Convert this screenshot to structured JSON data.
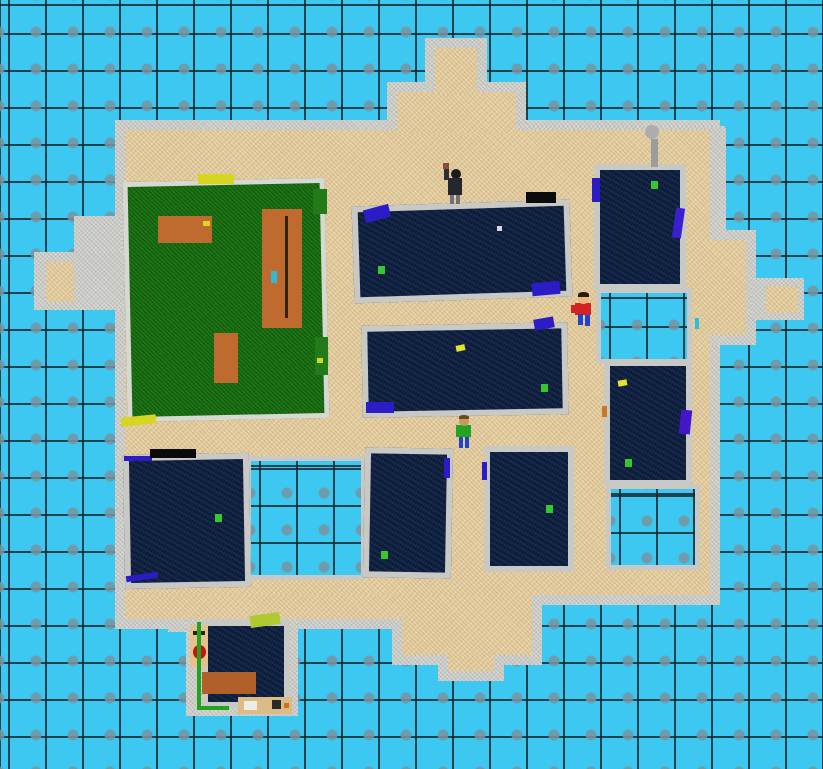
{
  "scene": {
    "width": 823,
    "height": 769
  },
  "palette": {
    "water": "#3DC8F2",
    "grid_line": "#222C30",
    "tile_square": "#8FA4B0",
    "sand": "#E2CB9C",
    "concrete": "#C8C8C4",
    "wall_light": "#D8D8D2",
    "grass": "#156B0F",
    "roof_navy": "#10203E",
    "table_orange": "#BF6B30",
    "marker_green": "#35C82E",
    "marker_yellow": "#E3E32A",
    "flag_blue": "#2B1CC6",
    "shirt_red": "#D22222",
    "shirt_green": "#22A322",
    "pants_blue": "#2244C8"
  },
  "island": {
    "rim": 10,
    "sand": [
      {
        "name": "island-core",
        "x": 125,
        "y": 130,
        "w": 585,
        "h": 465
      },
      {
        "name": "island-east-bulge",
        "x": 700,
        "y": 240,
        "w": 46,
        "h": 95
      },
      {
        "name": "island-southwest-strip",
        "x": 125,
        "y": 595,
        "w": 280,
        "h": 24
      },
      {
        "name": "south-pier-wide",
        "x": 402,
        "y": 595,
        "w": 130,
        "h": 60
      },
      {
        "name": "south-pier-nub",
        "x": 448,
        "y": 655,
        "w": 46,
        "h": 16
      },
      {
        "name": "north-pier-wide",
        "x": 397,
        "y": 92,
        "w": 119,
        "h": 42
      },
      {
        "name": "north-pier-nub",
        "x": 435,
        "y": 48,
        "w": 42,
        "h": 46
      }
    ],
    "concrete": [
      {
        "name": "west-arm-platform",
        "x": 34,
        "y": 252,
        "w": 92,
        "h": 58
      },
      {
        "name": "east-platform",
        "x": 752,
        "y": 278,
        "w": 52,
        "h": 42
      },
      {
        "name": "north-wall-band",
        "x": 525,
        "y": 126,
        "w": 200,
        "h": 16
      },
      {
        "name": "northeast-rim-wall",
        "x": 706,
        "y": 128,
        "w": 20,
        "h": 112
      },
      {
        "name": "northwest-step",
        "x": 74,
        "y": 216,
        "w": 48,
        "h": 36
      },
      {
        "name": "southwest-step",
        "x": 168,
        "y": 604,
        "w": 36,
        "h": 28
      },
      {
        "name": "shop-pad",
        "x": 186,
        "y": 616,
        "w": 112,
        "h": 100
      }
    ],
    "sand_pads": [
      {
        "name": "west-arm-sand-pad",
        "x": 46,
        "y": 262,
        "w": 28,
        "h": 40
      },
      {
        "name": "east-platform-sand-pad",
        "x": 766,
        "y": 286,
        "w": 32,
        "h": 27
      }
    ]
  },
  "pools": [
    {
      "name": "pool-southwest",
      "x": 246,
      "y": 456,
      "w": 120,
      "h": 124
    },
    {
      "name": "pool-east-upper",
      "x": 596,
      "y": 288,
      "w": 96,
      "h": 76
    },
    {
      "name": "pool-east-lower",
      "x": 606,
      "y": 484,
      "w": 94,
      "h": 86
    }
  ],
  "park": {
    "base": {
      "name": "park-lawn",
      "x": 125,
      "y": 180,
      "w": 202,
      "h": 240,
      "rot": -1.2
    },
    "items": [
      {
        "name": "picnic-table-small",
        "x": 158,
        "y": 216,
        "w": 54,
        "h": 27,
        "color": "#BF6B30"
      },
      {
        "name": "picnic-table-small-dot",
        "x": 203,
        "y": 221,
        "w": 7,
        "h": 5,
        "color": "#D8D820"
      },
      {
        "name": "picnic-table-large",
        "x": 262,
        "y": 209,
        "w": 40,
        "h": 119,
        "color": "#BF6B30"
      },
      {
        "name": "picnic-bench-line",
        "x": 285,
        "y": 216,
        "w": 3,
        "h": 102,
        "color": "#33230E"
      },
      {
        "name": "table-item-cyan",
        "x": 271,
        "y": 271,
        "w": 6,
        "h": 12,
        "color": "#2EB9DC"
      },
      {
        "name": "tree-stump",
        "x": 214,
        "y": 333,
        "w": 24,
        "h": 50,
        "color": "#BF6B30"
      },
      {
        "name": "bench-yellow-north",
        "x": 198,
        "y": 174,
        "w": 36,
        "h": 10,
        "color": "#D6D622"
      },
      {
        "name": "bench-yellow-south",
        "x": 121,
        "y": 416,
        "w": 35,
        "h": 9,
        "color": "#D6D622",
        "rot": -6
      },
      {
        "name": "bench-green-east-a",
        "x": 313,
        "y": 189,
        "w": 14,
        "h": 25,
        "color": "#237A18"
      },
      {
        "name": "bench-green-east-b",
        "x": 315,
        "y": 337,
        "w": 13,
        "h": 38,
        "color": "#237A18"
      },
      {
        "name": "bench-green-east-dot",
        "x": 317,
        "y": 358,
        "w": 6,
        "h": 5,
        "color": "#D6D622"
      }
    ]
  },
  "buildings": [
    {
      "name": "building-north-long",
      "x": 353,
      "y": 203,
      "w": 218,
      "h": 97,
      "rot": -1.8
    },
    {
      "name": "building-mid-long",
      "x": 362,
      "y": 324,
      "w": 206,
      "h": 92,
      "rot": -1
    },
    {
      "name": "building-northeast",
      "x": 594,
      "y": 164,
      "w": 92,
      "h": 126,
      "rot": 0
    },
    {
      "name": "building-east",
      "x": 604,
      "y": 360,
      "w": 88,
      "h": 126,
      "rot": 0
    },
    {
      "name": "building-southwest",
      "x": 124,
      "y": 454,
      "w": 126,
      "h": 134,
      "rot": -1
    },
    {
      "name": "building-south-a",
      "x": 364,
      "y": 448,
      "w": 88,
      "h": 130,
      "rot": 1
    },
    {
      "name": "building-south-b",
      "x": 484,
      "y": 446,
      "w": 90,
      "h": 126,
      "rot": 0
    },
    {
      "name": "shop-roof",
      "x": 202,
      "y": 620,
      "w": 88,
      "h": 88,
      "rot": 0
    }
  ],
  "marks": [
    {
      "name": "roof-marker-green",
      "x": 378,
      "y": 266,
      "w": 7,
      "h": 8,
      "color": "#35C82E"
    },
    {
      "name": "roof-marker-green",
      "x": 541,
      "y": 384,
      "w": 7,
      "h": 8,
      "color": "#35C82E"
    },
    {
      "name": "roof-marker-green",
      "x": 651,
      "y": 181,
      "w": 7,
      "h": 8,
      "color": "#35C82E"
    },
    {
      "name": "roof-marker-green",
      "x": 625,
      "y": 459,
      "w": 7,
      "h": 8,
      "color": "#35C82E"
    },
    {
      "name": "roof-marker-green",
      "x": 215,
      "y": 514,
      "w": 7,
      "h": 8,
      "color": "#35C82E"
    },
    {
      "name": "roof-marker-green",
      "x": 381,
      "y": 551,
      "w": 7,
      "h": 8,
      "color": "#35C82E"
    },
    {
      "name": "roof-marker-green",
      "x": 546,
      "y": 505,
      "w": 7,
      "h": 8,
      "color": "#35C82E"
    },
    {
      "name": "roof-marker-yellow",
      "x": 456,
      "y": 345,
      "w": 9,
      "h": 6,
      "color": "#E3E32A",
      "rot": -12
    },
    {
      "name": "roof-marker-yellow",
      "x": 618,
      "y": 380,
      "w": 9,
      "h": 6,
      "color": "#E3E32A",
      "rot": -10
    },
    {
      "name": "roof-speck-white",
      "x": 497,
      "y": 226,
      "w": 5,
      "h": 5,
      "color": "#D8D8D8"
    },
    {
      "name": "roof-flag-blue",
      "x": 364,
      "y": 207,
      "w": 26,
      "h": 13,
      "color": "#2B1CC6",
      "rot": -15
    },
    {
      "name": "roof-flag-blue",
      "x": 532,
      "y": 282,
      "w": 28,
      "h": 13,
      "color": "#2B1CC6",
      "rot": -5
    },
    {
      "name": "roof-flag-blue",
      "x": 592,
      "y": 178,
      "w": 8,
      "h": 24,
      "color": "#2B1CC6"
    },
    {
      "name": "roof-flag-blue",
      "x": 674,
      "y": 208,
      "w": 9,
      "h": 30,
      "color": "#3A1FD0",
      "rot": 8
    },
    {
      "name": "roof-flag-blue",
      "x": 534,
      "y": 318,
      "w": 20,
      "h": 11,
      "color": "#2B1CC6",
      "rot": -10
    },
    {
      "name": "roof-flag-blue",
      "x": 366,
      "y": 402,
      "w": 28,
      "h": 11,
      "color": "#2B1CC6"
    },
    {
      "name": "roof-flag-blue",
      "x": 680,
      "y": 410,
      "w": 11,
      "h": 24,
      "color": "#4416C8",
      "rot": 6
    },
    {
      "name": "roof-flag-blue",
      "x": 444,
      "y": 458,
      "w": 6,
      "h": 20,
      "color": "#2B1CC6"
    },
    {
      "name": "roof-flag-blue",
      "x": 482,
      "y": 462,
      "w": 5,
      "h": 18,
      "color": "#2B1CC6"
    },
    {
      "name": "roof-flag-blue",
      "x": 124,
      "y": 456,
      "w": 28,
      "h": 5,
      "color": "#2B1CC6"
    },
    {
      "name": "roof-flag-blue",
      "x": 126,
      "y": 574,
      "w": 32,
      "h": 6,
      "color": "#2B1CC6",
      "rot": -8
    },
    {
      "name": "roof-speck-orange",
      "x": 602,
      "y": 406,
      "w": 5,
      "h": 11,
      "color": "#C87828"
    },
    {
      "name": "bench-black",
      "x": 526,
      "y": 192,
      "w": 30,
      "h": 11,
      "color": "#0B0B0B"
    },
    {
      "name": "bench-black",
      "x": 150,
      "y": 449,
      "w": 46,
      "h": 9,
      "color": "#0B0B0B"
    },
    {
      "name": "lamppost-head",
      "x": 645,
      "y": 125,
      "w": 14,
      "h": 14,
      "color": "#ADADAD",
      "round": true
    },
    {
      "name": "lamppost-stem",
      "x": 651,
      "y": 139,
      "w": 7,
      "h": 28,
      "color": "#9C9C9C"
    },
    {
      "name": "speck-teal",
      "x": 695,
      "y": 318,
      "w": 4,
      "h": 11,
      "color": "#28C0DC"
    }
  ],
  "shop_items": [
    {
      "name": "shop-face-board",
      "x": 190,
      "y": 625,
      "w": 18,
      "h": 42,
      "color": "#E5C18E"
    },
    {
      "name": "shop-face-eye-left",
      "x": 193,
      "y": 631,
      "w": 4,
      "h": 4,
      "color": "#222222"
    },
    {
      "name": "shop-face-eye-right",
      "x": 201,
      "y": 631,
      "w": 4,
      "h": 4,
      "color": "#222222"
    },
    {
      "name": "shop-face-mouth",
      "x": 193,
      "y": 645,
      "w": 13,
      "h": 14,
      "color": "#C61414",
      "round": true
    },
    {
      "name": "shop-counter-brown",
      "x": 202,
      "y": 672,
      "w": 54,
      "h": 22,
      "color": "#B06028"
    },
    {
      "name": "shop-roof-blob",
      "x": 250,
      "y": 614,
      "w": 30,
      "h": 12,
      "color": "#AFC930",
      "rot": -8
    },
    {
      "name": "shop-workbench",
      "x": 238,
      "y": 697,
      "w": 54,
      "h": 17,
      "color": "#DCBC86"
    },
    {
      "name": "shop-workbench-sink",
      "x": 244,
      "y": 701,
      "w": 13,
      "h": 9,
      "color": "#EDEDE8"
    },
    {
      "name": "shop-workbench-stove",
      "x": 272,
      "y": 700,
      "w": 9,
      "h": 9,
      "color": "#2A2A2A"
    },
    {
      "name": "shop-workbench-dot",
      "x": 284,
      "y": 703,
      "w": 5,
      "h": 5,
      "color": "#D07020"
    },
    {
      "name": "shop-edge-green-left",
      "x": 197,
      "y": 622,
      "w": 4,
      "h": 88,
      "color": "#22A31E"
    },
    {
      "name": "shop-edge-green-bottom",
      "x": 197,
      "y": 706,
      "w": 32,
      "h": 4,
      "color": "#22A31E"
    }
  ],
  "characters": [
    {
      "name": "character-dark-figure",
      "parts": [
        {
          "part": "raised-arm",
          "x": 444,
          "y": 167,
          "w": 5,
          "h": 13,
          "color": "#2E2E38"
        },
        {
          "part": "held-item",
          "x": 443,
          "y": 163,
          "w": 6,
          "h": 6,
          "color": "#8E4A3A"
        },
        {
          "part": "head",
          "x": 451,
          "y": 169,
          "w": 10,
          "h": 10,
          "color": "#1C1C1C",
          "round": true
        },
        {
          "part": "torso",
          "x": 448,
          "y": 178,
          "w": 14,
          "h": 17,
          "color": "#26262F"
        },
        {
          "part": "leg-left",
          "x": 450,
          "y": 195,
          "w": 4,
          "h": 9,
          "color": "#70707A"
        },
        {
          "part": "leg-right",
          "x": 456,
          "y": 195,
          "w": 4,
          "h": 9,
          "color": "#70707A"
        }
      ]
    },
    {
      "name": "character-red-kid",
      "parts": [
        {
          "part": "arm",
          "x": 571,
          "y": 305,
          "w": 5,
          "h": 8,
          "color": "#D22222"
        },
        {
          "part": "torso",
          "x": 575,
          "y": 303,
          "w": 16,
          "h": 12,
          "color": "#D22222"
        },
        {
          "part": "head",
          "x": 578,
          "y": 293,
          "w": 11,
          "h": 11,
          "color": "#ECB77E",
          "round": true
        },
        {
          "part": "hair",
          "x": 578,
          "y": 292,
          "w": 11,
          "h": 5,
          "color": "#2A1808",
          "r": "50% 50% 0 0"
        },
        {
          "part": "leg-left",
          "x": 578,
          "y": 314,
          "w": 5,
          "h": 11,
          "color": "#2244C8"
        },
        {
          "part": "leg-right",
          "x": 585,
          "y": 315,
          "w": 5,
          "h": 11,
          "color": "#2244C8"
        }
      ]
    },
    {
      "name": "character-green-guy",
      "parts": [
        {
          "part": "torso",
          "x": 456,
          "y": 425,
          "w": 15,
          "h": 12,
          "color": "#22A322"
        },
        {
          "part": "head",
          "x": 459,
          "y": 416,
          "w": 10,
          "h": 10,
          "color": "#C9985E",
          "round": true
        },
        {
          "part": "hair",
          "x": 459,
          "y": 415,
          "w": 10,
          "h": 4,
          "color": "#6B4A1E",
          "r": "50% 50% 0 0"
        },
        {
          "part": "leg-left",
          "x": 459,
          "y": 437,
          "w": 4,
          "h": 11,
          "color": "#2244C8"
        },
        {
          "part": "leg-right",
          "x": 465,
          "y": 437,
          "w": 4,
          "h": 11,
          "color": "#2244C8"
        }
      ]
    }
  ]
}
